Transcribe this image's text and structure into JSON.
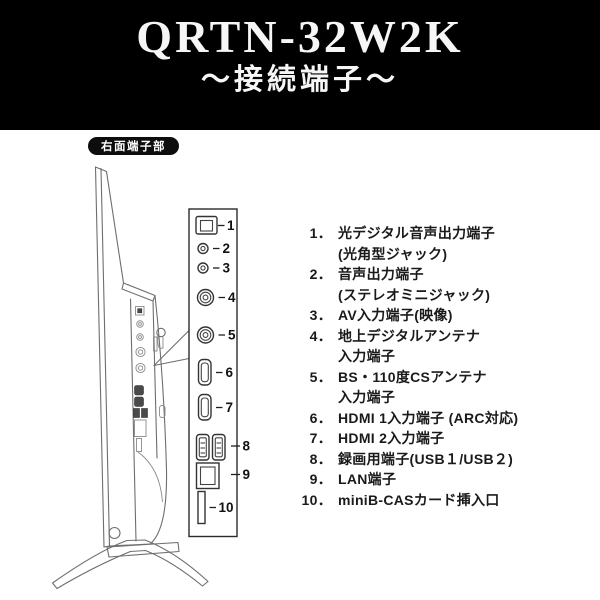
{
  "header": {
    "model": "QRTN-32W2K",
    "subtitle": "～接続端子～"
  },
  "diagram": {
    "section_label": "右面端子部",
    "port_labels": [
      "1",
      "2",
      "3",
      "4",
      "5",
      "6",
      "7",
      "8",
      "9",
      "10"
    ]
  },
  "terminal_list": {
    "rows": [
      {
        "num": "1．",
        "text": "光デジタル音声出力端子"
      },
      {
        "num": "",
        "text": "(光角型ジャック)"
      },
      {
        "num": "2．",
        "text": "音声出力端子"
      },
      {
        "num": "",
        "text": "(ステレオミニジャック)"
      },
      {
        "num": "3．",
        "text": "AV入力端子(映像)"
      },
      {
        "num": "4．",
        "text": "地上デジタルアンテナ"
      },
      {
        "num": "",
        "text": "入力端子"
      },
      {
        "num": "5．",
        "text": "BS・110度CSアンテナ"
      },
      {
        "num": "",
        "text": "入力端子"
      },
      {
        "num": "6．",
        "text": "HDMI 1入力端子 (ARC対応)"
      },
      {
        "num": "7．",
        "text": "HDMI 2入力端子"
      },
      {
        "num": "8．",
        "text": "録画用端子(USB１/USB２)"
      },
      {
        "num": "9．",
        "text": "LAN端子"
      },
      {
        "num": "10．",
        "text": "miniB-CASカード挿入口"
      }
    ]
  },
  "colors": {
    "header_bg": "#000000",
    "header_text": "#f6f6f6",
    "pill_bg": "#0d0d0d",
    "line_art": "#6e6e6e",
    "panel_stroke": "#2b2b2b",
    "list_text": "#1a1a1a",
    "page_bg": "#ffffff"
  }
}
